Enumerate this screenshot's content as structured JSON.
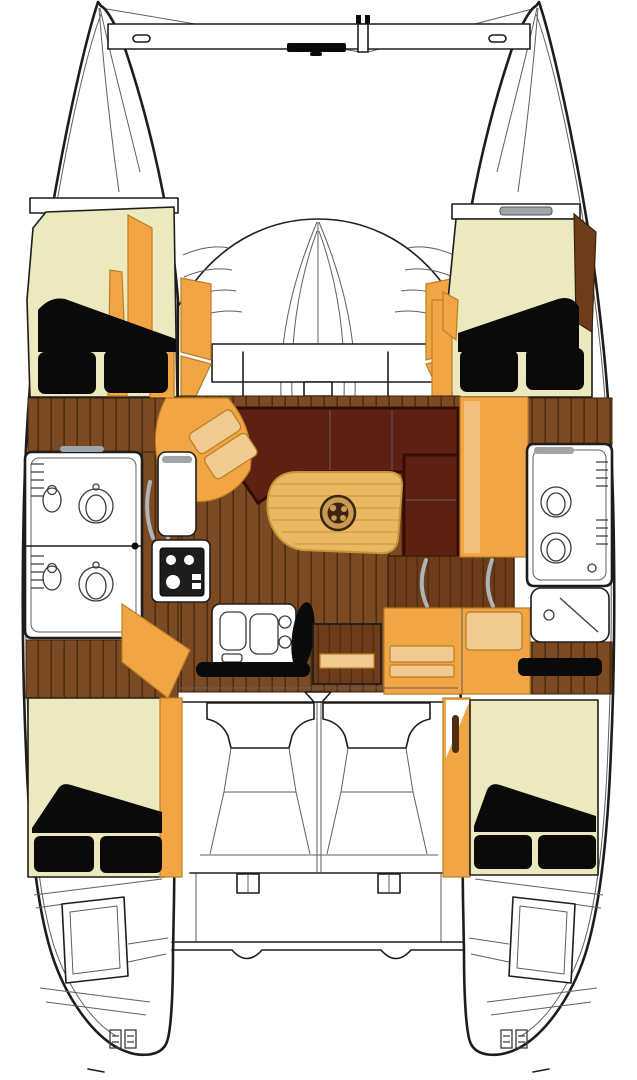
{
  "palette": {
    "outline": "#1E1D1B",
    "line_soft": "#5F5F5F",
    "hull_white": "#FFFFFF",
    "bed_cream": "#EBE9BD",
    "cushion_black": "#0A0A0A",
    "orange": "#F2A544",
    "orange_deep": "#B97E22",
    "orange_pale": "#F0CA90",
    "wood": "#7B4A23",
    "wood_line": "#4E2D0F",
    "wood_red": "#6E3C1B",
    "settee": "#5E2012",
    "settee_dark": "#330D04",
    "table_wood": "#E9B863",
    "table_line": "#C8953B",
    "medallion_gold": "#C89A52",
    "medallion_dark": "#3B2410",
    "hatch_gray": "#9FA5A8",
    "chrome": "#ADB5B9",
    "fixture_line": "#3C3C3C"
  },
  "areas": [
    {
      "id": "bow-crossbeam",
      "label": "bow crossbeam with anchor roller and bridle fitting"
    },
    {
      "id": "foredeck",
      "label": "foredeck and coachroof front with center hatch"
    },
    {
      "id": "port-forward-cabin",
      "label": "port forward double berth"
    },
    {
      "id": "starboard-forward-cabin",
      "label": "starboard forward double berth"
    },
    {
      "id": "port-head",
      "label": "port hull head with twin basins"
    },
    {
      "id": "starboard-head",
      "label": "starboard hull head and shower"
    },
    {
      "id": "galley",
      "label": "port galley with stove and twin sink"
    },
    {
      "id": "salon",
      "label": "salon with U-settee and cocktail table"
    },
    {
      "id": "companionway",
      "label": "companionway steps with grab rails"
    },
    {
      "id": "nav-seating",
      "label": "starboard seating and drawer unit"
    },
    {
      "id": "cockpit",
      "label": "cockpit with twin pedestal seats"
    },
    {
      "id": "port-aft-cabin",
      "label": "port aft double berth"
    },
    {
      "id": "starboard-aft-cabin",
      "label": "starboard aft double berth"
    },
    {
      "id": "transoms",
      "label": "twin transom boarding steps"
    }
  ]
}
